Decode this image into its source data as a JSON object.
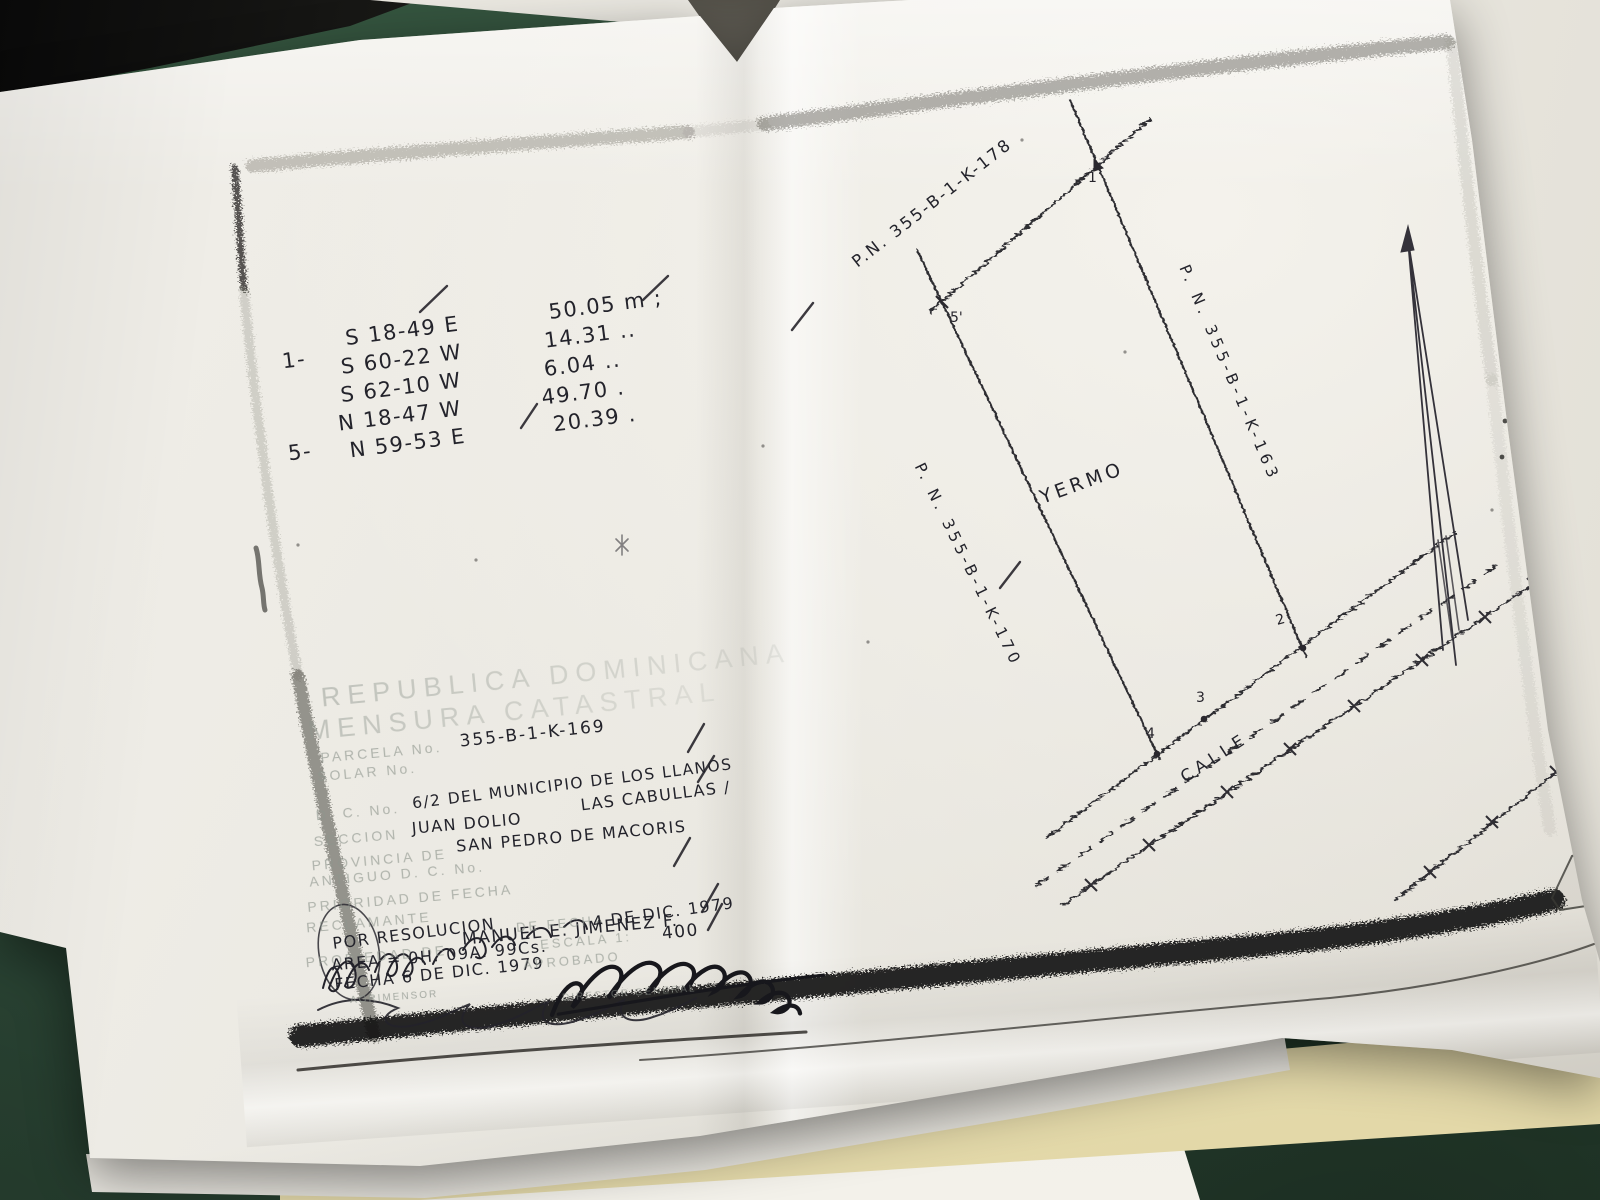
{
  "colors": {
    "table_green": "#2f4c3a",
    "paper": "#eae8e1",
    "manila": "#ece2b4",
    "ink": "#23232b",
    "stamp_gray": "#8f968e",
    "frame_black": "#171513"
  },
  "document": {
    "bearings": {
      "point_start": "1-",
      "point_end": "5-",
      "rows": [
        {
          "bearing": "S 18-49 E",
          "distance": "50.05 m ;"
        },
        {
          "bearing": "S 60-22 W",
          "distance": "14.31 .."
        },
        {
          "bearing": "S 62-10 W",
          "distance": "6.04 .."
        },
        {
          "bearing": "N 18-47 W",
          "distance": "49.70 ."
        },
        {
          "bearing": "N 59-53 E",
          "distance": "20.39 ."
        }
      ]
    },
    "parcel": {
      "label_top": "P.N. 355-B-1-K-178",
      "label_right": "P. N. 355-B-1-K-163",
      "label_left": "P. N. 355-B-1-K-170",
      "land_use": "YERMO",
      "street": "CALLE",
      "points": {
        "p1": "1",
        "p2": "2",
        "p3": "3",
        "p4": "4",
        "p5": "5'"
      }
    },
    "stamp": {
      "title1": "REPUBLICA DOMINICANA",
      "title2": "MENSURA CATASTRAL",
      "parcela_label": "PARCELA No.",
      "solar_label": "SOLAR No.",
      "dc_label": "D. C. No.",
      "seccion_label": "SECCION",
      "provincia_label": "PROVINCIA DE",
      "antiguo_label": "ANTIGUO D. C. No.",
      "prioridad_label": "PRIORIDAD DE FECHA",
      "reclamante_label": "RECLAMANTE",
      "propiedad_label": "PROPIEDAD DE",
      "de_fecha_label": "DE FECHA",
      "escala_label": "ESCALA 1:",
      "aprobado_label": "APROBADO",
      "agrimensor_label": "AGRIMENSOR",
      "director_label": "DIRECTOR GENERAL"
    },
    "handwritten": {
      "parcela_no": "355-B-1-K-169",
      "dc_value": "6/2 DEL MUNICIPIO DE LOS LLANOS",
      "seccion_value": "JUAN DOLIO",
      "lugar_value": "LAS CABULLAS /",
      "provincia_value": "SAN PEDRO DE MACORIS",
      "propiedad_value": "MANUEL E. JIMENEZ F.",
      "por_resolucion": "POR RESOLUCION",
      "resolucion_fecha": "4 DE DIC. 1979",
      "area_value": "AREA = 0H. 09A. 99Cs.",
      "escala_value": "400",
      "fecha_value": "FECHA 6 DE DIC. 1979"
    },
    "ghost_text": "NEVADO"
  }
}
